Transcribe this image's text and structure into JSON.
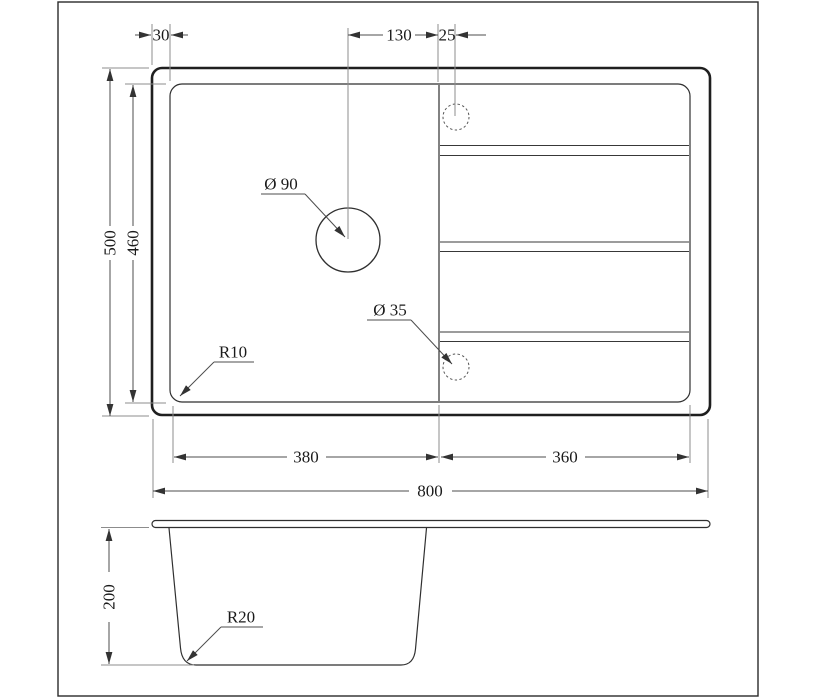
{
  "colors": {
    "background": "#ffffff",
    "object_line_strong": "#1f1f1f",
    "object_line": "#2f2f2f",
    "dim_line": "#4d4d4d",
    "extension_line": "#8c8c8c",
    "text": "#1a1a1a"
  },
  "top_view": {
    "dim_rim_offset": "30",
    "dim_hole_to_divider": "130",
    "dim_divider_to_tap": "25",
    "dim_overall_depth": "500",
    "dim_inner_depth": "460",
    "dim_bowl_width": "380",
    "dim_drainboard_width": "360",
    "dim_overall_width": "800",
    "label_drain_hole": "Ø 90",
    "label_tap_hole": "Ø 35",
    "label_corner_radius": "R10"
  },
  "section_view": {
    "dim_bowl_depth": "200",
    "label_bottom_radius": "R20"
  }
}
